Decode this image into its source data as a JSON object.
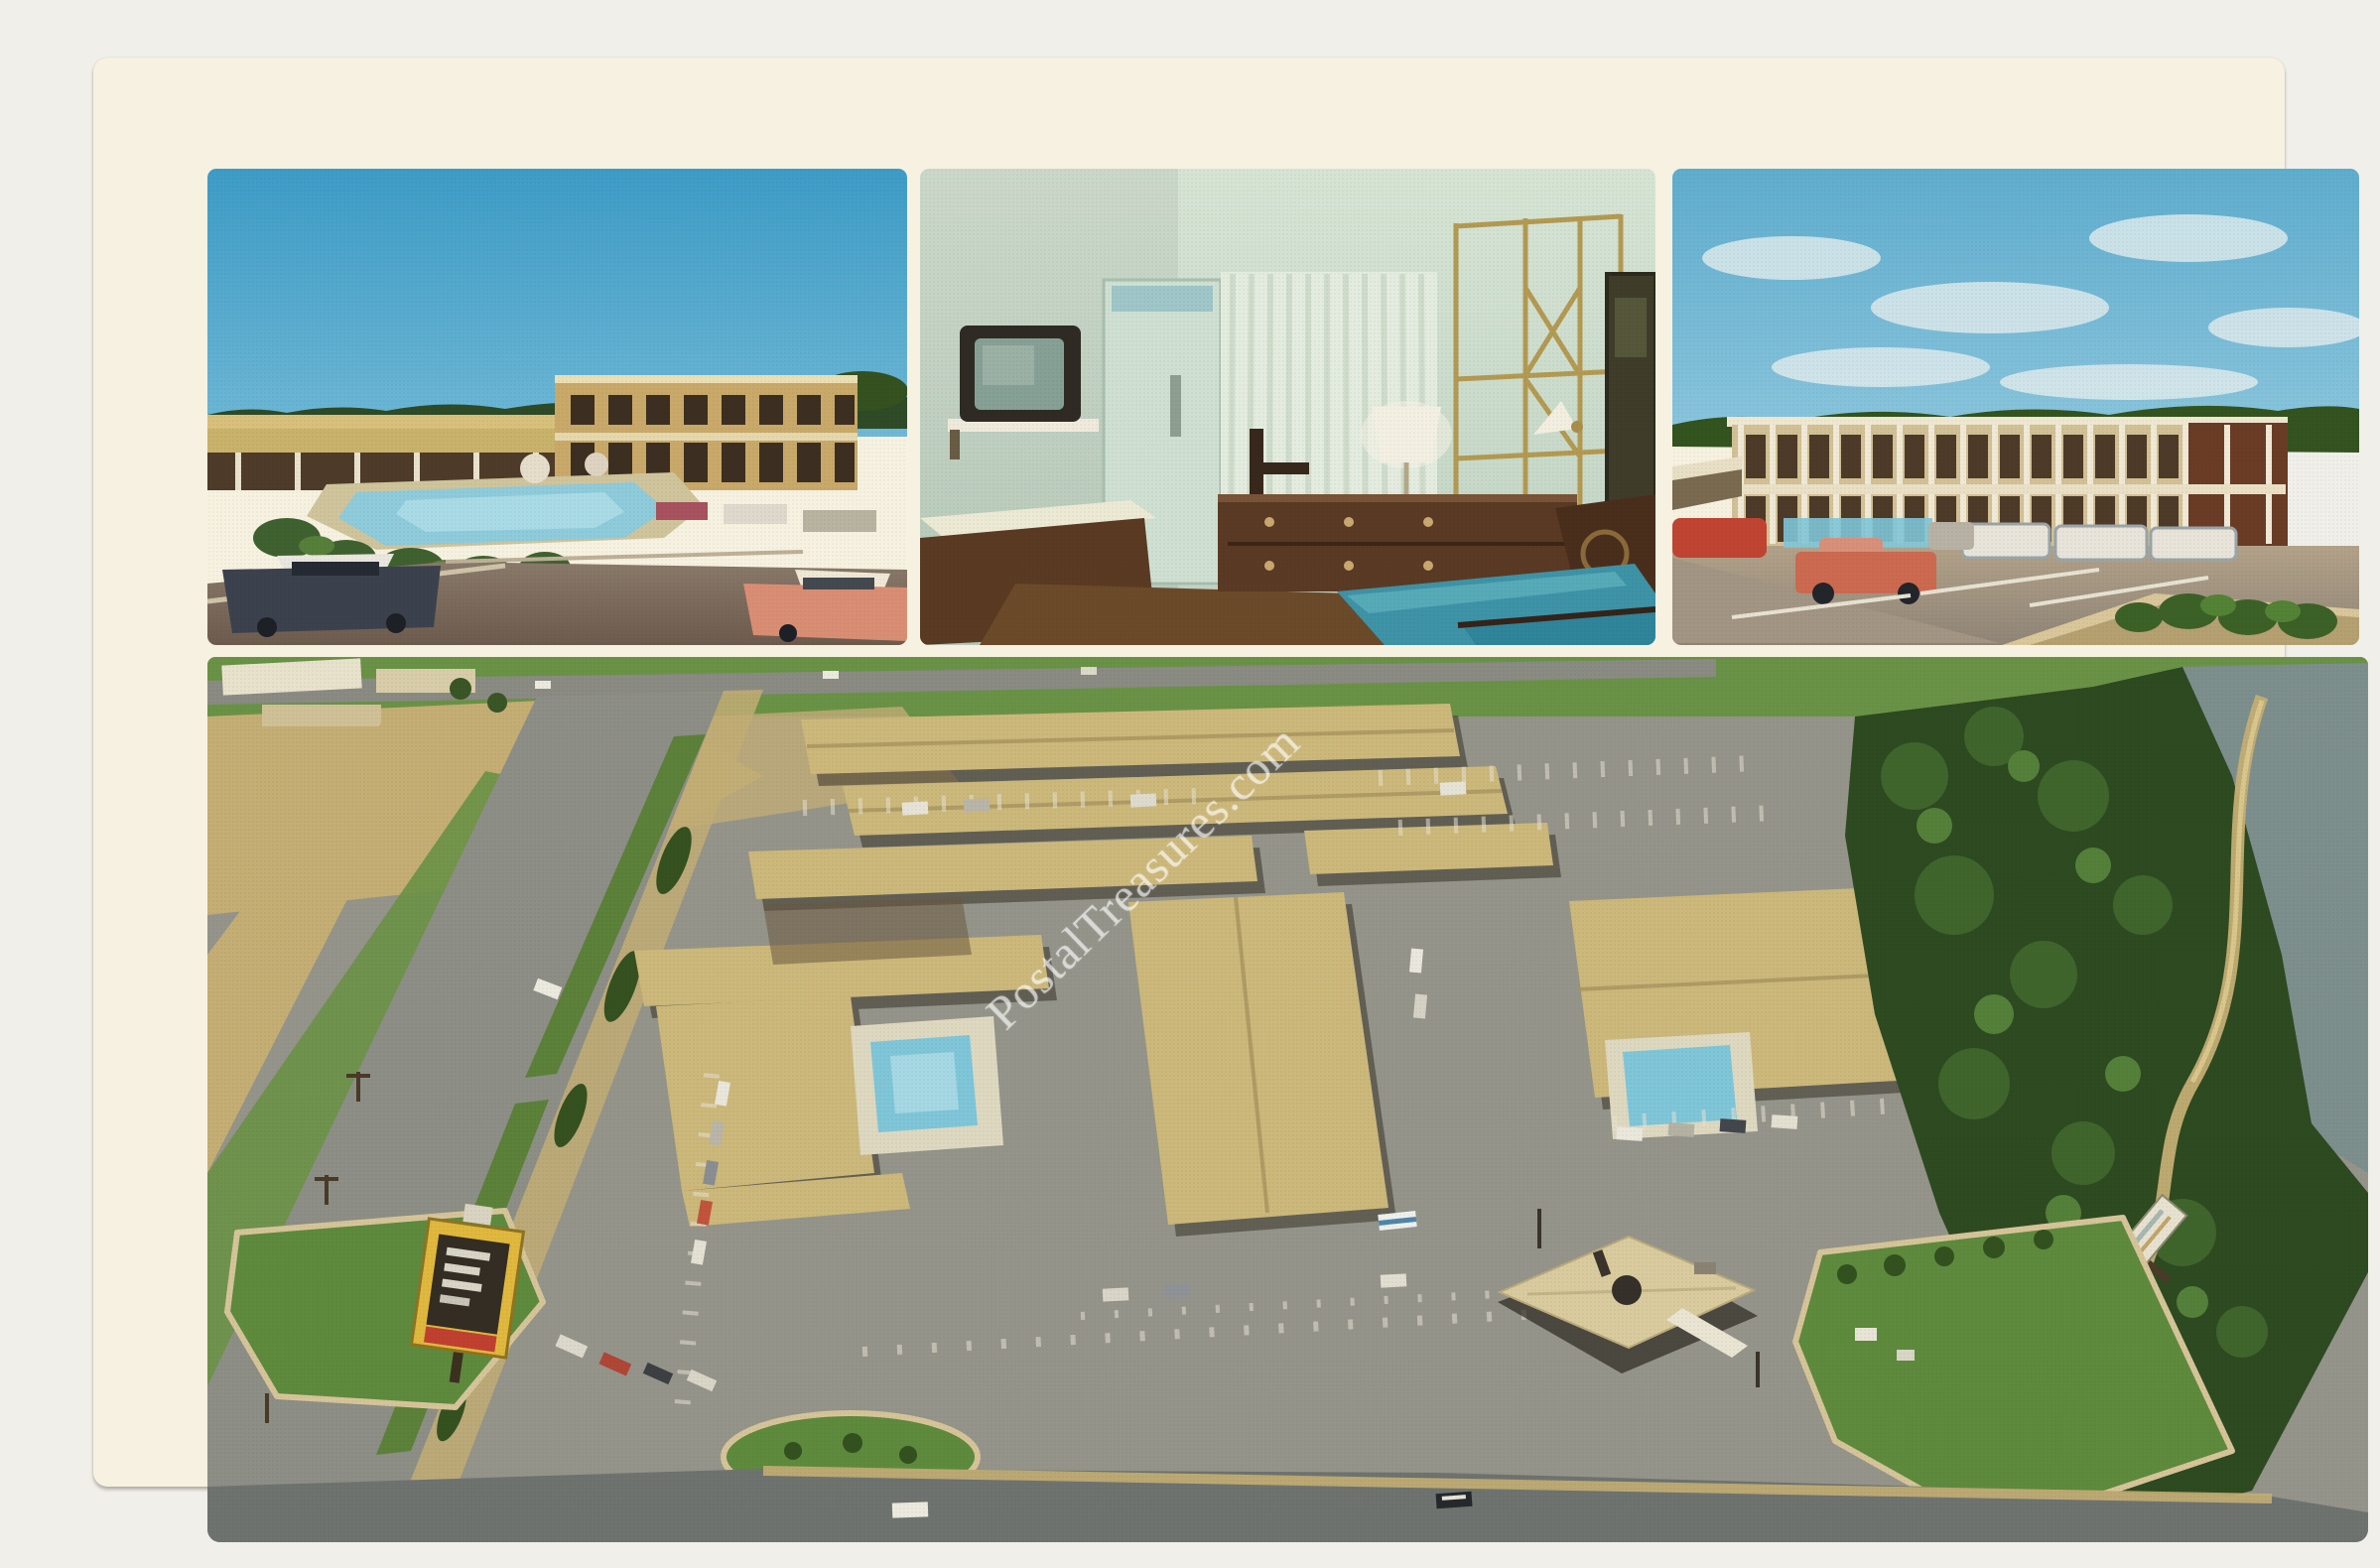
{
  "postcard": {
    "watermark": {
      "text": "PostalTreasures.com"
    },
    "photos": [
      {
        "name": "motel-courtyard-pool-photo"
      },
      {
        "name": "guest-room-interior-photo"
      },
      {
        "name": "two-story-motel-exterior-photo"
      },
      {
        "name": "aerial-view-motel-complex-photo"
      }
    ]
  },
  "palette": {
    "scan_bg": "#f0efea",
    "card_paper": "#f6f1e0",
    "sky_left": "#3d9cc6",
    "sky_left_low": "#6fb8d6",
    "sky_right": "#5fadce",
    "cloud_white": "#e9f0ef",
    "pool_aqua": "#7fc6d8",
    "roof_tan": "#ccb87a",
    "dirt_tan": "#c4ae74",
    "asphalt": "#94948a",
    "highway_gray": "#8d8e86",
    "grass": "#5e8a3d",
    "grass_bright": "#6a9246",
    "tree_dark": "#2e4a21",
    "water_lake": "#7d8f8c",
    "wall_mint": "#d6e4d4",
    "carpet_brown": "#6b4a2a",
    "wood_dark": "#53341f",
    "bed_teal": "#3e93a6",
    "gold_brass": "#b39a52",
    "car_red": "#c04432",
    "car_coral": "#d98e74",
    "sign_yellow": "#e0b83e",
    "watermark_color": "rgba(255,255,255,0.55)"
  }
}
